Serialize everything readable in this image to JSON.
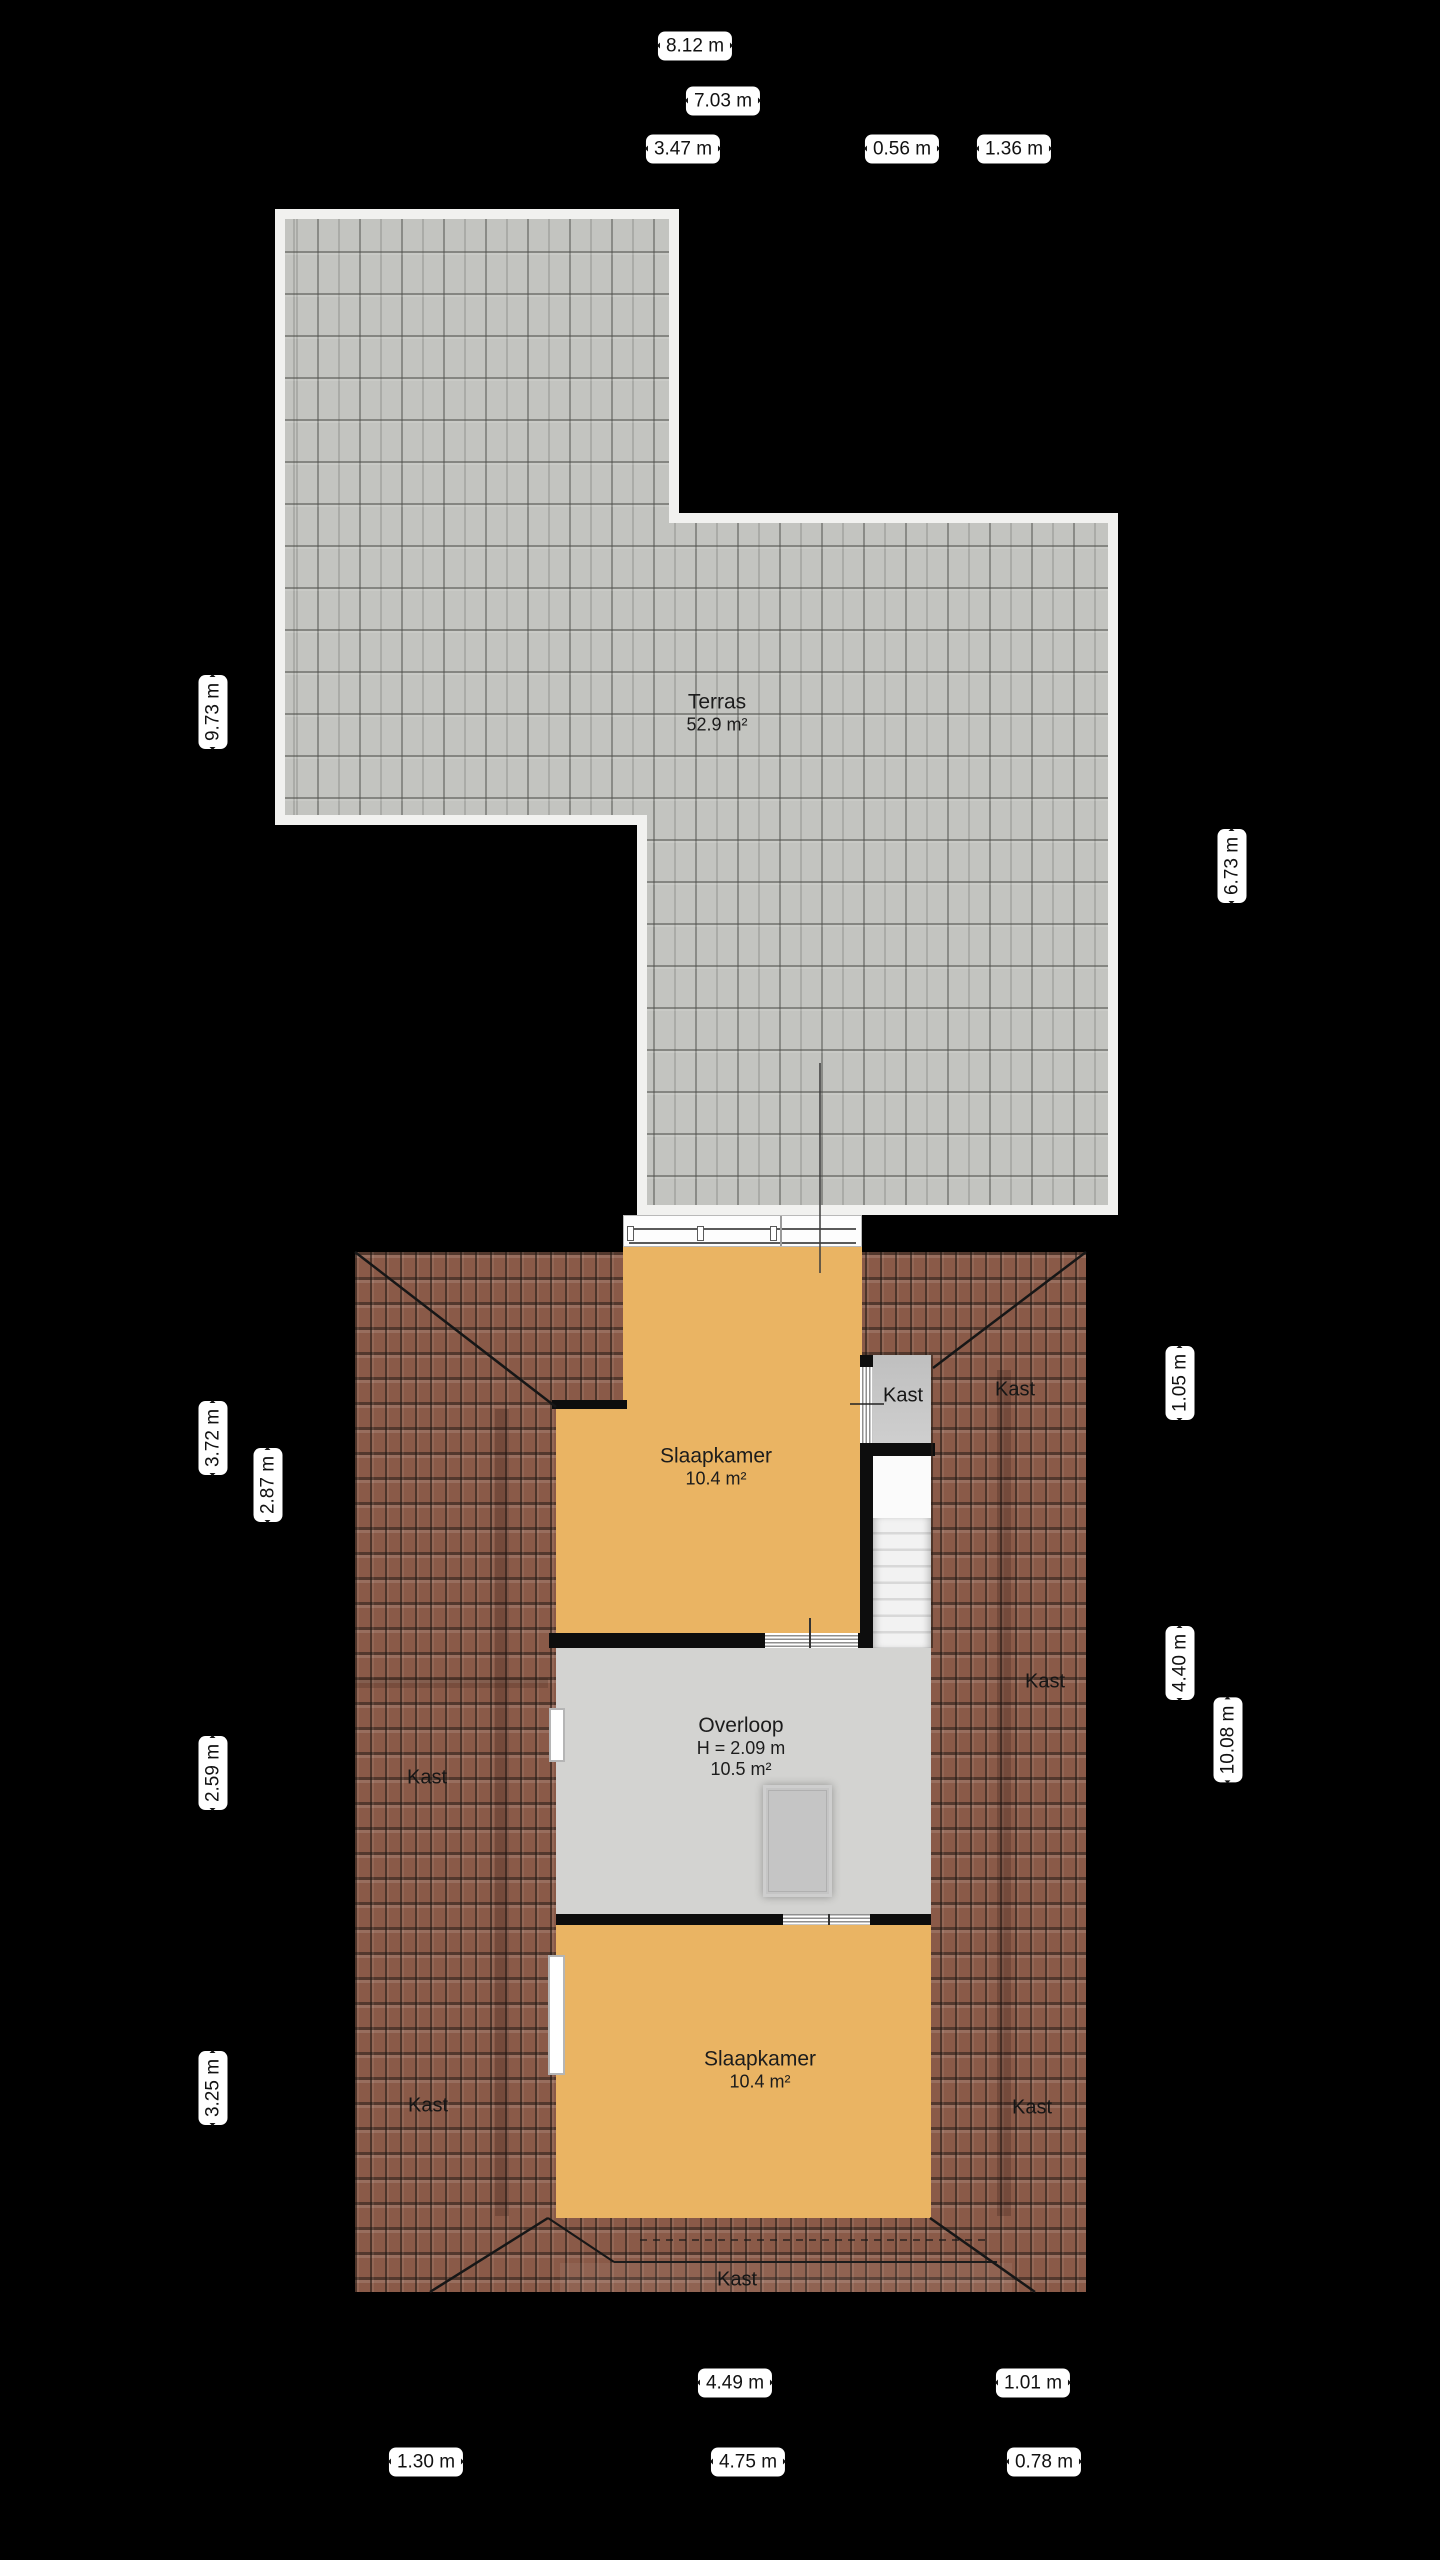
{
  "plan_type": "floorplan-attic-level",
  "palette": {
    "background": "#000000",
    "terrace_tile": "#c3c4c0",
    "terrace_border": "#f1f1ef",
    "roof_brown": "#8a5a48",
    "room_orange": "#eab463",
    "floor_gray": "#d3d3d1",
    "closet_gray": "#cbcbcb",
    "wall_black": "#0d0d0d",
    "label_background": "#ffffff",
    "label_text": "#111111"
  },
  "rooms": {
    "terras": {
      "name": "Terras",
      "area": "52.9 m²"
    },
    "slaapkamer1": {
      "name": "Slaapkamer",
      "area": "10.4 m²"
    },
    "overloop": {
      "name": "Overloop",
      "height": "H = 2.09 m",
      "area": "10.5 m²"
    },
    "slaapkamer2": {
      "name": "Slaapkamer",
      "area": "10.4 m²"
    }
  },
  "closets": {
    "label": "Kast"
  },
  "dimensions": {
    "top": [
      {
        "label": "8.12 m"
      },
      {
        "label": "7.03 m"
      },
      {
        "label": "3.47 m"
      },
      {
        "label": "0.56 m"
      },
      {
        "label": "1.36 m"
      }
    ],
    "left": [
      {
        "label": "9.73 m"
      },
      {
        "label": "3.72 m"
      },
      {
        "label": "2.87 m"
      },
      {
        "label": "2.59 m"
      },
      {
        "label": "3.25 m"
      }
    ],
    "right": [
      {
        "label": "6.73 m"
      },
      {
        "label": "1.05 m"
      },
      {
        "label": "4.40 m"
      },
      {
        "label": "10.08 m"
      }
    ],
    "bottom": [
      {
        "label": "4.49 m"
      },
      {
        "label": "1.01 m"
      },
      {
        "label": "1.30 m"
      },
      {
        "label": "4.75 m"
      },
      {
        "label": "0.78 m"
      }
    ]
  }
}
